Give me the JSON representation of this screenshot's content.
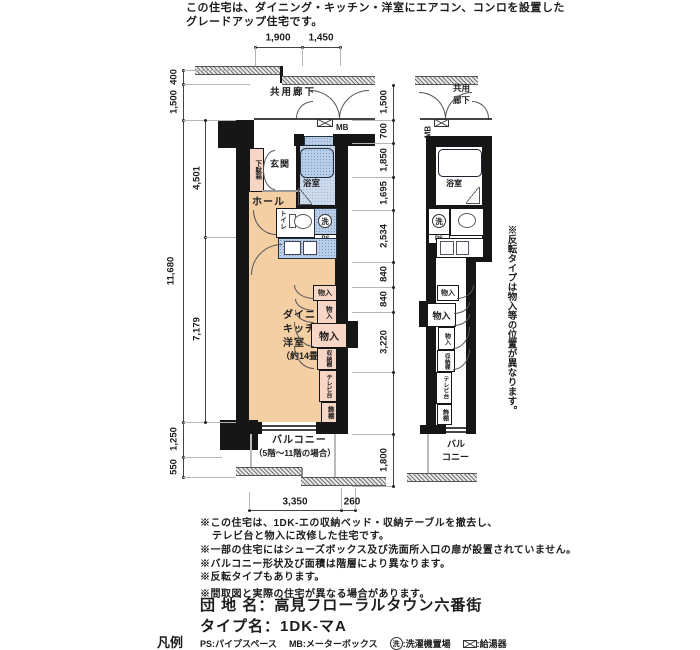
{
  "header": {
    "line1": "この住宅は、ダイニング・キッチン・洋室にエアコン、コンロを設置した",
    "line2": "グレードアップ住宅です。"
  },
  "dims": {
    "top1": "1,900",
    "top2": "1,450",
    "left400": "400",
    "left1500": "1,500",
    "left11680": "11,680",
    "left4501": "4,501",
    "left7179": "7,179",
    "left1250": "1,250",
    "left550": "550",
    "mid1500": "1,500",
    "mid700": "700",
    "mid1850": "1,850",
    "mid1695": "1,695",
    "mid2534": "2,534",
    "mid840a": "840",
    "mid840b": "840",
    "mid3220": "3,220",
    "mid1800": "1,800",
    "bottom3350": "3,350",
    "bottom260": "260"
  },
  "main_plan": {
    "corridor": "共用廊下",
    "mb": "MB",
    "entrance": "玄関",
    "shoe_cabinet": "下駄箱",
    "bath": "浴室",
    "hall": "ホール",
    "toilet": "トイレ",
    "washer": "洗",
    "ps": "PS",
    "room_line1": "ダイニング・",
    "room_line2": "キッチン・",
    "room_line3": "洋室",
    "room_line4": "（約14畳）",
    "closets": [
      "物入",
      "物入",
      "物入",
      "収納棚",
      "テレビ台",
      "飾棚"
    ],
    "balcony_line1": "バルコニー",
    "balcony_line2": "（5階～11階の場合）"
  },
  "mini_plan": {
    "corridor_line1": "共用",
    "corridor_line2": "廊下",
    "mb": "MB",
    "bath": "浴室",
    "washer": "洗",
    "ps": "PS",
    "closets": [
      "物入",
      "物入",
      "物入",
      "収納棚",
      "テレビ台",
      "飾棚"
    ],
    "balcony_line1": "バル",
    "balcony_line2": "コニー"
  },
  "side_note": "※反転タイプは物入等の位置が異なります。",
  "notes": {
    "n1": "※この住宅は、1DK-エの収納ベッド・収納テーブルを撤去し、",
    "n2": "テレビ台と物入に改修した住宅です。",
    "n3": "※一部の住宅にはシューズボックス及び洗面所入口の扉が設置されていません。",
    "n4": "※バルコニー形状及び面積は階層により異なります。",
    "n5": "※反転タイプもあります。",
    "n6": "※間取図と実際の住宅が異なる場合があります。"
  },
  "estate": {
    "label": "団 地 名：",
    "value": "高見フローラルタウン六番街"
  },
  "unit_type": {
    "label": "タイプ名：",
    "value": "1DK-マA"
  },
  "legend": {
    "title": "凡例",
    "ps": "PS:パイプスペース",
    "mb": "MB:メーターボックス",
    "washer_key": "洗",
    "washer_desc": ":洗濯機置場",
    "heater_desc": ":給湯器"
  },
  "colors": {
    "wall": "#161616",
    "room_peach": "#f5cfa4",
    "closet_pink": "#f8d6c5",
    "fixture_blue": "#b8cde7",
    "bath_blue": "#cddaed"
  }
}
